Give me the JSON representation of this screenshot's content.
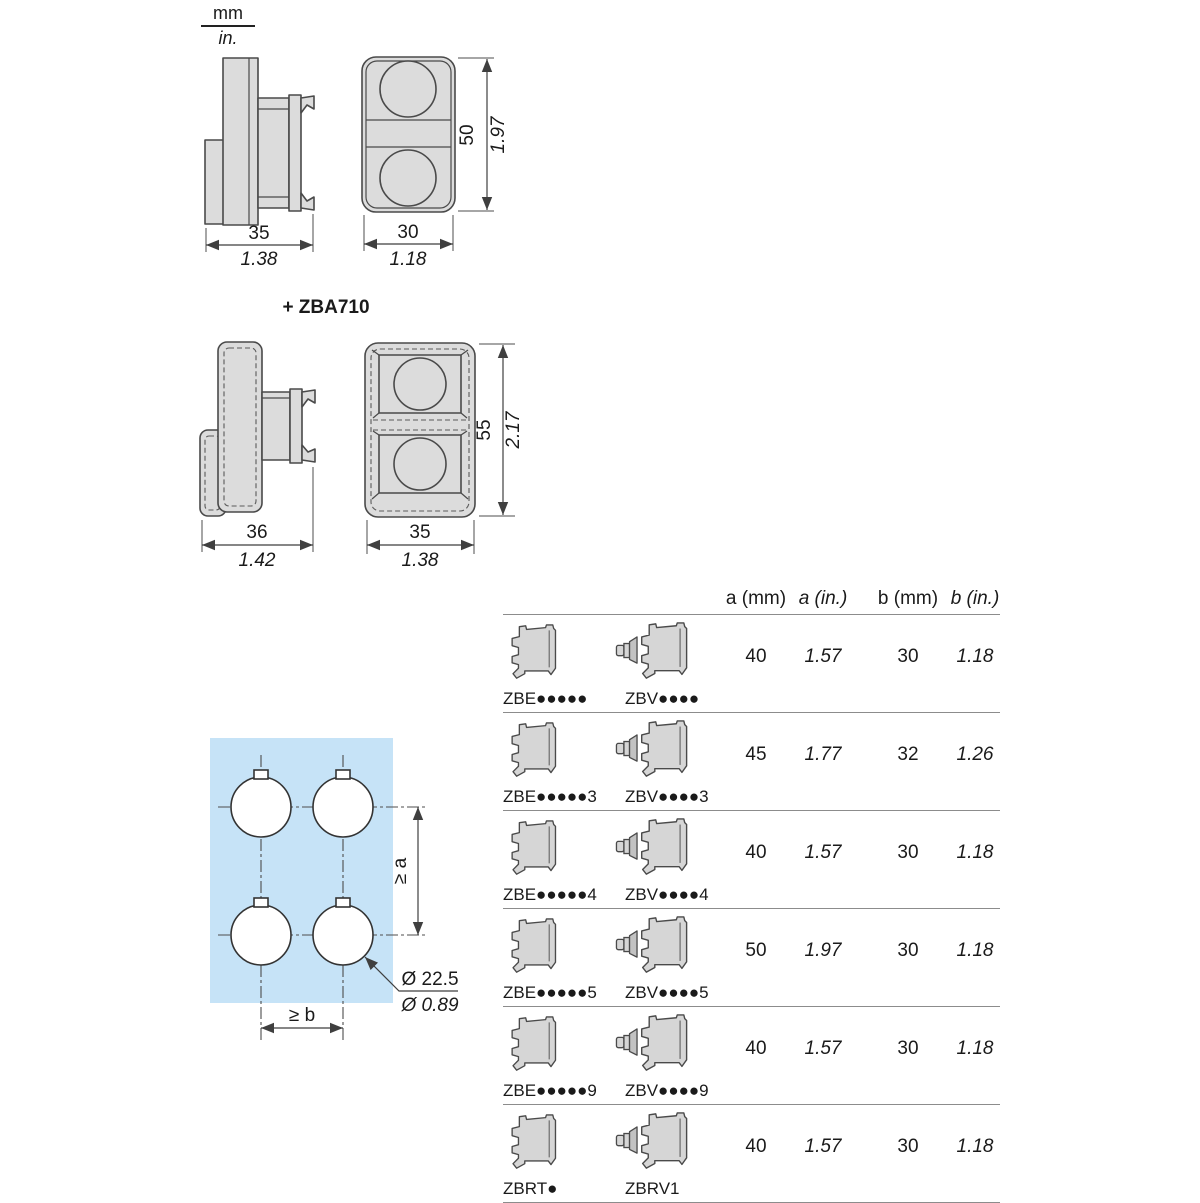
{
  "units": {
    "mm": "mm",
    "inch": "in."
  },
  "drawing1": {
    "side": {
      "width_mm": "35",
      "width_in": "1.38"
    },
    "front": {
      "width_mm": "30",
      "width_in": "1.18",
      "height_mm": "50",
      "height_in": "1.97"
    }
  },
  "drawing2": {
    "title": "+ ZBA710",
    "side": {
      "width_mm": "36",
      "width_in": "1.42"
    },
    "front": {
      "width_mm": "35",
      "width_in": "1.38",
      "height_mm": "55",
      "height_in": "2.17"
    }
  },
  "drilling": {
    "dim_vertical": "≥ a",
    "dim_horizontal": "≥ b",
    "diameter_mm": "Ø 22.5",
    "diameter_in": "Ø 0.89",
    "accent_color": "#29a8e0",
    "panel_color": "#c6e3f7"
  },
  "table": {
    "headers": [
      "a (mm)",
      "a (in.)",
      "b (mm)",
      "b (in.)"
    ],
    "rows": [
      {
        "model_e": "ZBE●●●●●",
        "model_v": "ZBV●●●●",
        "a_mm": "40",
        "a_in": "1.57",
        "b_mm": "30",
        "b_in": "1.18"
      },
      {
        "model_e": "ZBE●●●●●3",
        "model_v": "ZBV●●●●3",
        "a_mm": "45",
        "a_in": "1.77",
        "b_mm": "32",
        "b_in": "1.26"
      },
      {
        "model_e": "ZBE●●●●●4",
        "model_v": "ZBV●●●●4",
        "a_mm": "40",
        "a_in": "1.57",
        "b_mm": "30",
        "b_in": "1.18"
      },
      {
        "model_e": "ZBE●●●●●5",
        "model_v": "ZBV●●●●5",
        "a_mm": "50",
        "a_in": "1.97",
        "b_mm": "30",
        "b_in": "1.18"
      },
      {
        "model_e": "ZBE●●●●●9",
        "model_v": "ZBV●●●●9",
        "a_mm": "40",
        "a_in": "1.57",
        "b_mm": "30",
        "b_in": "1.18"
      },
      {
        "model_e": "ZBRT●",
        "model_v": "ZBRV1",
        "a_mm": "40",
        "a_in": "1.57",
        "b_mm": "30",
        "b_in": "1.18"
      }
    ]
  }
}
